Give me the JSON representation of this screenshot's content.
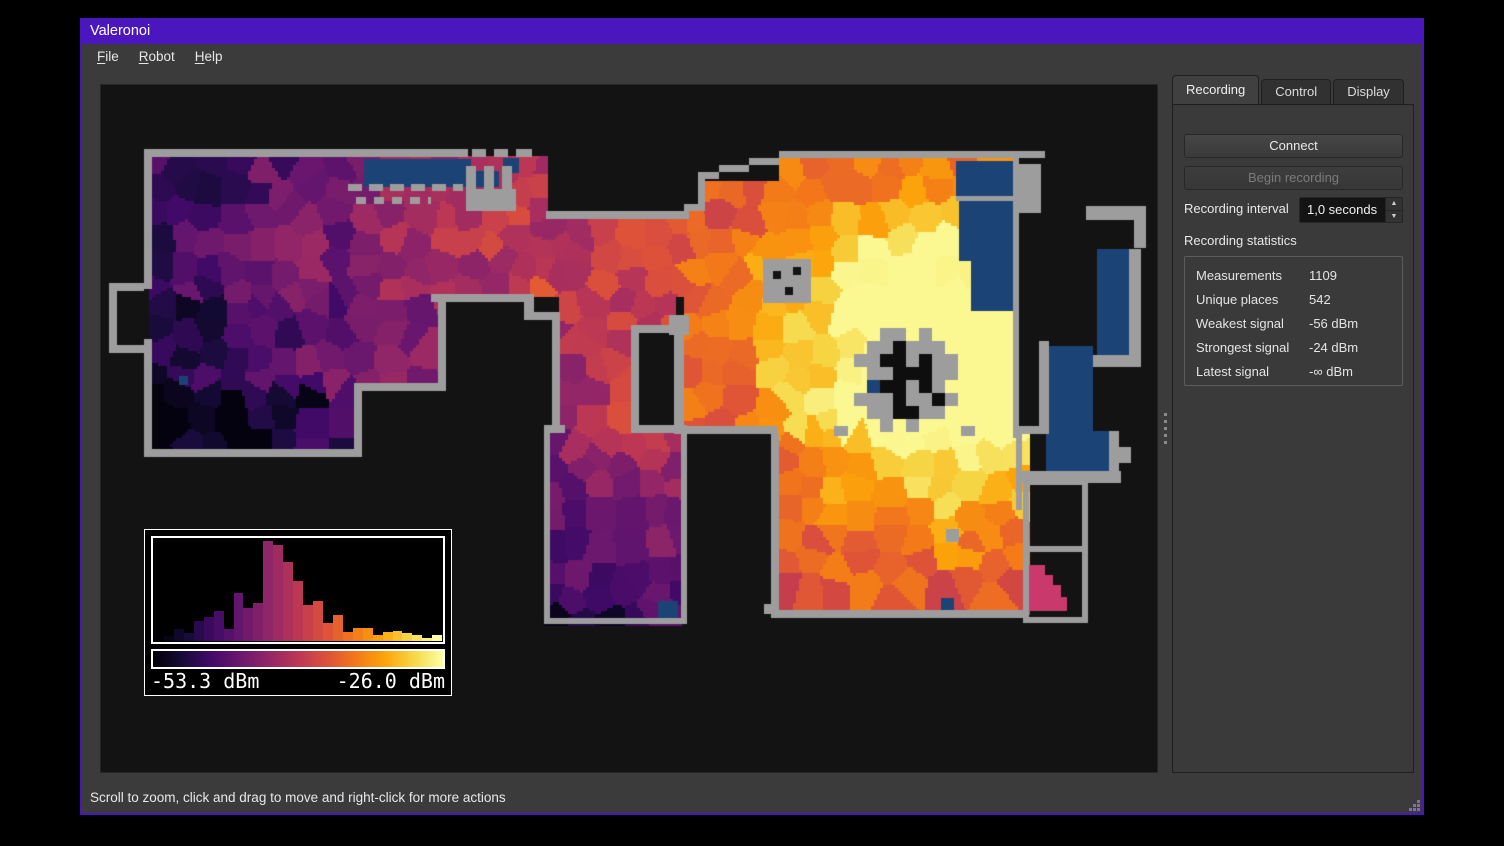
{
  "window": {
    "title": "Valeronoi"
  },
  "menu": {
    "items": [
      {
        "label": "File"
      },
      {
        "label": "Robot"
      },
      {
        "label": "Help"
      }
    ]
  },
  "panel": {
    "tabs": [
      {
        "label": "Recording",
        "active": true
      },
      {
        "label": "Control",
        "active": false
      },
      {
        "label": "Display",
        "active": false
      }
    ],
    "buttons": {
      "connect": "Connect",
      "begin_recording": "Begin recording"
    },
    "interval": {
      "label": "Recording interval",
      "value": "1,0 seconds"
    },
    "statistics": {
      "title": "Recording statistics",
      "rows": [
        [
          "Measurements",
          "1109"
        ],
        [
          "Unique places",
          "542"
        ],
        [
          "Weakest signal",
          "-56 dBm"
        ],
        [
          "Strongest signal",
          "-24 dBm"
        ],
        [
          "Latest signal",
          "-∞ dBm"
        ]
      ]
    }
  },
  "status_bar": {
    "text": "Scroll to zoom, click and drag to move and right-click for more actions"
  },
  "legend": {
    "min_label": "-53.3 dBm",
    "max_label": "-26.0 dBm"
  },
  "chart_data": {
    "type": "bar",
    "title": "Signal strength histogram (legend overlay)",
    "xlabel_left": "-53.3 dBm",
    "xlabel_right": "-26.0 dBm",
    "x_range_dbm": [
      -53.3,
      -26.0
    ],
    "values": [
      0.1,
      0.05,
      0.12,
      0.08,
      0.2,
      0.24,
      0.3,
      0.12,
      0.48,
      0.33,
      0.38,
      1.0,
      0.96,
      0.79,
      0.6,
      0.36,
      0.4,
      0.18,
      0.26,
      0.09,
      0.13,
      0.13,
      0.06,
      0.09,
      0.1,
      0.08,
      0.06,
      0.03,
      0.06
    ],
    "bar_colormap": "inferno",
    "legend_position": "bottom-left"
  },
  "map": {
    "bg": "#131313",
    "wall_color": "#9d9d9d",
    "unmeasured_floor_color": "#1c4376",
    "stair_color": "#c9396b",
    "colormap": [
      "#000004",
      "#160b39",
      "#420a68",
      "#6a176e",
      "#932667",
      "#bc3754",
      "#dd513a",
      "#f37819",
      "#fca50a",
      "#f6d746",
      "#fcffa4"
    ],
    "hotspot": [
      840,
      276
    ],
    "falloff": 1100,
    "hotspot_boost": 0.38,
    "hotspot_sigma": 110,
    "cell_spacing": 26,
    "value_jitter": 0.1,
    "seed": 7,
    "regions": [
      {
        "rect": [
          48,
          71,
          397,
          141
        ],
        "offset": -0.1
      },
      {
        "rect": [
          48,
          212,
          289,
          90
        ],
        "offset": -0.16
      },
      {
        "rect": [
          48,
          302,
          205,
          66
        ],
        "offset": -0.3
      },
      {
        "rect": [
          445,
          134,
          138,
          78
        ],
        "offset": -0.18
      },
      {
        "rect": [
          458,
          212,
          115,
          36
        ],
        "offset": -0.2
      },
      {
        "rect": [
          458,
          248,
          72,
          98
        ],
        "offset": -0.2
      },
      {
        "rect": [
          443,
          346,
          137,
          193
        ],
        "offset": -0.26,
        "ygrad": -0.2
      },
      {
        "rect": [
          583,
          126,
          332,
          222
        ],
        "offset": -0.16
      },
      {
        "rect": [
          597,
          96,
          318,
          32
        ],
        "offset": -0.16
      },
      {
        "rect": [
          678,
          73,
          237,
          25
        ],
        "offset": -0.16
      },
      {
        "rect": [
          677,
          341,
          250,
          188
        ],
        "offset": -0.2
      }
    ],
    "blue_regions": [
      [
        263,
        74,
        107,
        28
      ],
      [
        373,
        86,
        25,
        16
      ],
      [
        402,
        73,
        16,
        15
      ],
      [
        855,
        76,
        60,
        35
      ],
      [
        858,
        116,
        54,
        60
      ],
      [
        870,
        176,
        42,
        50
      ],
      [
        948,
        261,
        44,
        133
      ],
      [
        945,
        346,
        65,
        42
      ],
      [
        996,
        164,
        32,
        106
      ],
      [
        557,
        516,
        20,
        20
      ],
      [
        840,
        513,
        13,
        16
      ],
      [
        78,
        291,
        9,
        9
      ]
    ],
    "walls": [
      [
        43,
        64,
        324,
        8
      ],
      [
        371,
        64,
        14,
        8
      ],
      [
        393,
        64,
        14,
        8
      ],
      [
        415,
        64,
        16,
        8
      ],
      [
        678,
        66,
        266,
        7
      ],
      [
        648,
        73,
        30,
        7
      ],
      [
        618,
        80,
        30,
        7
      ],
      [
        597,
        87,
        21,
        7
      ],
      [
        597,
        94,
        7,
        32
      ],
      [
        583,
        119,
        14,
        7
      ],
      [
        445,
        126,
        143,
        8
      ],
      [
        43,
        64,
        8,
        140
      ],
      [
        8,
        198,
        35,
        8
      ],
      [
        8,
        198,
        8,
        70
      ],
      [
        8,
        260,
        35,
        8
      ],
      [
        43,
        254,
        8,
        118
      ],
      [
        43,
        364,
        218,
        8
      ],
      [
        253,
        306,
        8,
        66
      ],
      [
        253,
        298,
        92,
        8
      ],
      [
        337,
        209,
        8,
        97
      ],
      [
        330,
        209,
        95,
        8
      ],
      [
        423,
        209,
        10,
        26
      ],
      [
        433,
        227,
        20,
        8
      ],
      [
        451,
        227,
        8,
        113
      ],
      [
        443,
        340,
        21,
        8
      ],
      [
        443,
        346,
        6,
        193
      ],
      [
        443,
        533,
        143,
        6
      ],
      [
        580,
        346,
        6,
        193
      ],
      [
        530,
        340,
        56,
        8
      ],
      [
        530,
        240,
        53,
        8
      ],
      [
        530,
        248,
        8,
        92
      ],
      [
        573,
        248,
        10,
        92
      ],
      [
        573,
        341,
        104,
        8
      ],
      [
        670,
        349,
        8,
        184
      ],
      [
        677,
        525,
        250,
        8
      ],
      [
        733,
        341,
        14,
        10
      ],
      [
        860,
        341,
        14,
        10
      ],
      [
        663,
        519,
        10,
        10
      ],
      [
        912,
        73,
        6,
        280
      ],
      [
        855,
        111,
        60,
        5
      ],
      [
        912,
        341,
        36,
        8
      ],
      [
        915,
        341,
        6,
        84
      ],
      [
        917,
        79,
        23,
        49
      ],
      [
        985,
        121,
        60,
        14
      ],
      [
        1033,
        135,
        12,
        28
      ],
      [
        1028,
        164,
        12,
        106
      ],
      [
        992,
        270,
        48,
        12
      ],
      [
        938,
        256,
        10,
        90
      ],
      [
        1008,
        346,
        10,
        44
      ],
      [
        1018,
        362,
        12,
        16
      ],
      [
        915,
        386,
        105,
        12
      ],
      [
        922,
        394,
        6,
        144
      ],
      [
        981,
        394,
        6,
        144
      ],
      [
        922,
        394,
        65,
        6
      ],
      [
        922,
        461,
        65,
        6
      ],
      [
        922,
        532,
        65,
        6
      ]
    ],
    "dashed_walls": [
      {
        "x1": 247,
        "x2": 362,
        "y": 99,
        "h": 7,
        "dash": 14,
        "gap": 7
      },
      {
        "x1": 255,
        "x2": 330,
        "y": 112,
        "h": 7,
        "dash": 10,
        "gap": 8
      }
    ],
    "castle": {
      "base": [
        365,
        104,
        50,
        22
      ],
      "teeth": [
        [
          365,
          81,
          10,
          23
        ],
        [
          383,
          81,
          10,
          23
        ],
        [
          401,
          81,
          10,
          23
        ]
      ]
    },
    "obstacles": [
      {
        "rect": [
          662,
          174,
          48,
          44
        ],
        "dots": [
          [
            672,
            186
          ],
          [
            692,
            182
          ],
          [
            684,
            202
          ]
        ]
      },
      {
        "rect": [
          568,
          230,
          20,
          20
        ],
        "dots": []
      },
      {
        "rect": [
          845,
          444,
          13,
          13
        ],
        "dots": []
      }
    ],
    "dock": {
      "origin": [
        753,
        243
      ],
      "cell": 13,
      "mask": [
        "..11.1..",
        ".112111.",
        "11221211",
        ".1122211",
        ".322121.",
        "11121121",
        ".112211.",
        "..1.1..."
      ]
    },
    "stair_cells": [
      [
        928,
        480,
        16,
        10
      ],
      [
        928,
        490,
        24,
        10
      ],
      [
        928,
        500,
        32,
        12
      ],
      [
        928,
        512,
        38,
        14
      ]
    ]
  }
}
